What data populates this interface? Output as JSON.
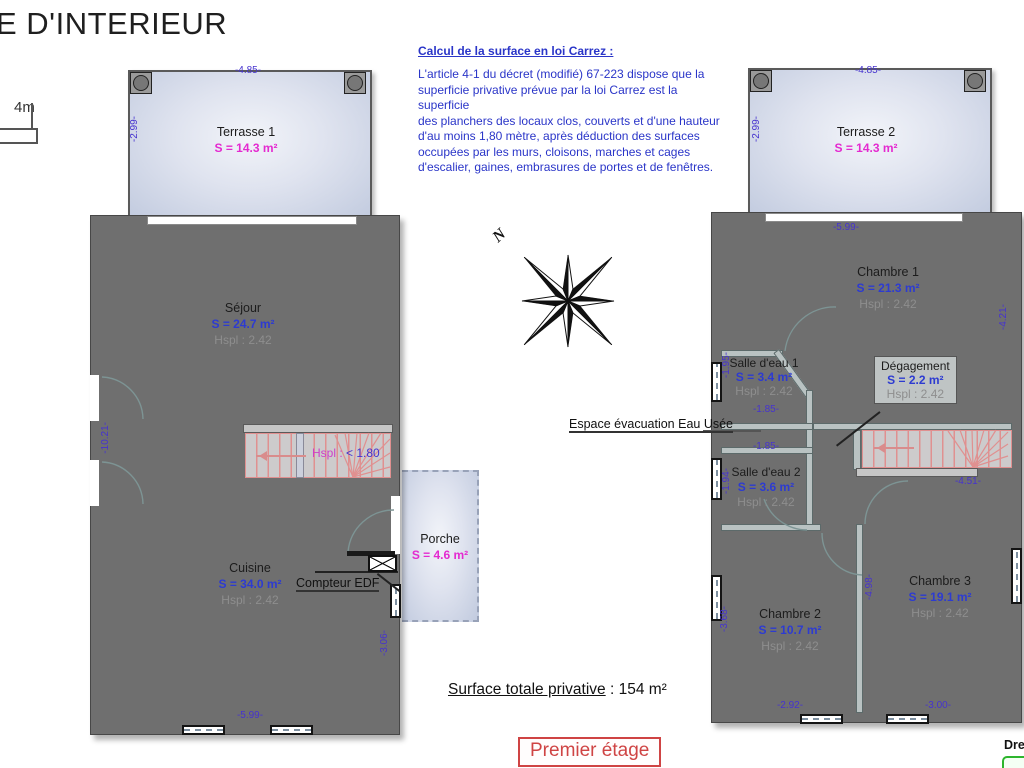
{
  "title": "E D'INTERIEUR",
  "scale_bar": {
    "label": "4m"
  },
  "carrez_note": {
    "heading": "Calcul de la surface en loi Carrez :",
    "body": "L'article 4-1 du décret (modifié) 67-223 dispose que la\nsuperficie privative prévue par la loi Carrez est la superficie\ndes planchers des locaux clos, couverts et d'une hauteur\nd'au moins 1,80 mètre, après déduction des surfaces\noccupées par les murs, cloisons, marches et cages\nd'escalier, gaines, embrasures de portes et de fenêtres."
  },
  "compass": {
    "north_label": "N"
  },
  "ground_floor": {
    "terrace": {
      "name": "Terrasse 1",
      "area": "S = 14.3 m²",
      "dim_top": "-4.85-",
      "dim_left": "-2.99-"
    },
    "sejour": {
      "name": "Séjour",
      "area": "S = 24.7 m²",
      "ceiling": "Hspl : 2.42"
    },
    "cuisine": {
      "name": "Cuisine",
      "area": "S = 34.0 m²",
      "ceiling": "Hspl : 2.42"
    },
    "porche": {
      "name": "Porche",
      "area": "S = 4.6 m²"
    },
    "stairs_label_a": "Hspl :",
    "stairs_label_b": "< 1.80",
    "compteur_label": "Compteur EDF",
    "dim_left": "-10.21-",
    "dim_bottom": "-5.99-",
    "dim_right": "-3.06-"
  },
  "first_floor": {
    "terrace": {
      "name": "Terrasse 2",
      "area": "S = 14.3 m²",
      "dim_top": "-4.85-",
      "dim_left": "-2.99-"
    },
    "chambre1": {
      "name": "Chambre 1",
      "area": "S = 21.3 m²",
      "ceiling": "Hspl : 2.42"
    },
    "salle_eau1": {
      "name": "Salle d'eau 1",
      "area": "S = 3.4 m²",
      "ceiling": "Hspl : 2.42"
    },
    "degagement": {
      "name": "Dégagement",
      "area": "S = 2.2 m²",
      "ceiling": "Hspl : 2.42"
    },
    "salle_eau2": {
      "name": "Salle d'eau 2",
      "area": "S = 3.6 m²",
      "ceiling": "Hspl : 2.42"
    },
    "chambre2": {
      "name": "Chambre 2",
      "area": "S = 10.7 m²",
      "ceiling": "Hspl : 2.42"
    },
    "chambre3": {
      "name": "Chambre 3",
      "area": "S = 19.1 m²",
      "ceiling": "Hspl : 2.42"
    },
    "evacuation_label": "Espace évacuation Eau Usée",
    "dim_top": "-5.99-",
    "dim_right": "-4.21-",
    "dim_se1_left": "-1.95-",
    "dim_se1_bottom": "-1.85-",
    "dim_shaft": "-1.85-",
    "dim_se2_left": "-1.94-",
    "dim_stairs": "-4.51-",
    "dim_ch2_left": "-3.68-",
    "dim_ch2_bottom": "-2.92-",
    "dim_ch3_left": "-4.98-",
    "dim_ch3_bottom": "-3.00-"
  },
  "footer": {
    "total_label": "Surface totale privative",
    "total_sep": " : ",
    "total_value": "154 m²",
    "floor_label": "Premier étage",
    "corner_text": "Dre"
  },
  "colors": {
    "room_fill": "#cdf2f5",
    "terrace_fill": "#c9d1e4",
    "wall": "#6f6f6f",
    "dim_text": "#4633cf",
    "area_blue": "#2d3bd1",
    "area_magenta": "#e42ad0",
    "note_blue": "#2a35c8",
    "floor_red": "#cf4444",
    "stairs_red": "#e09090"
  }
}
